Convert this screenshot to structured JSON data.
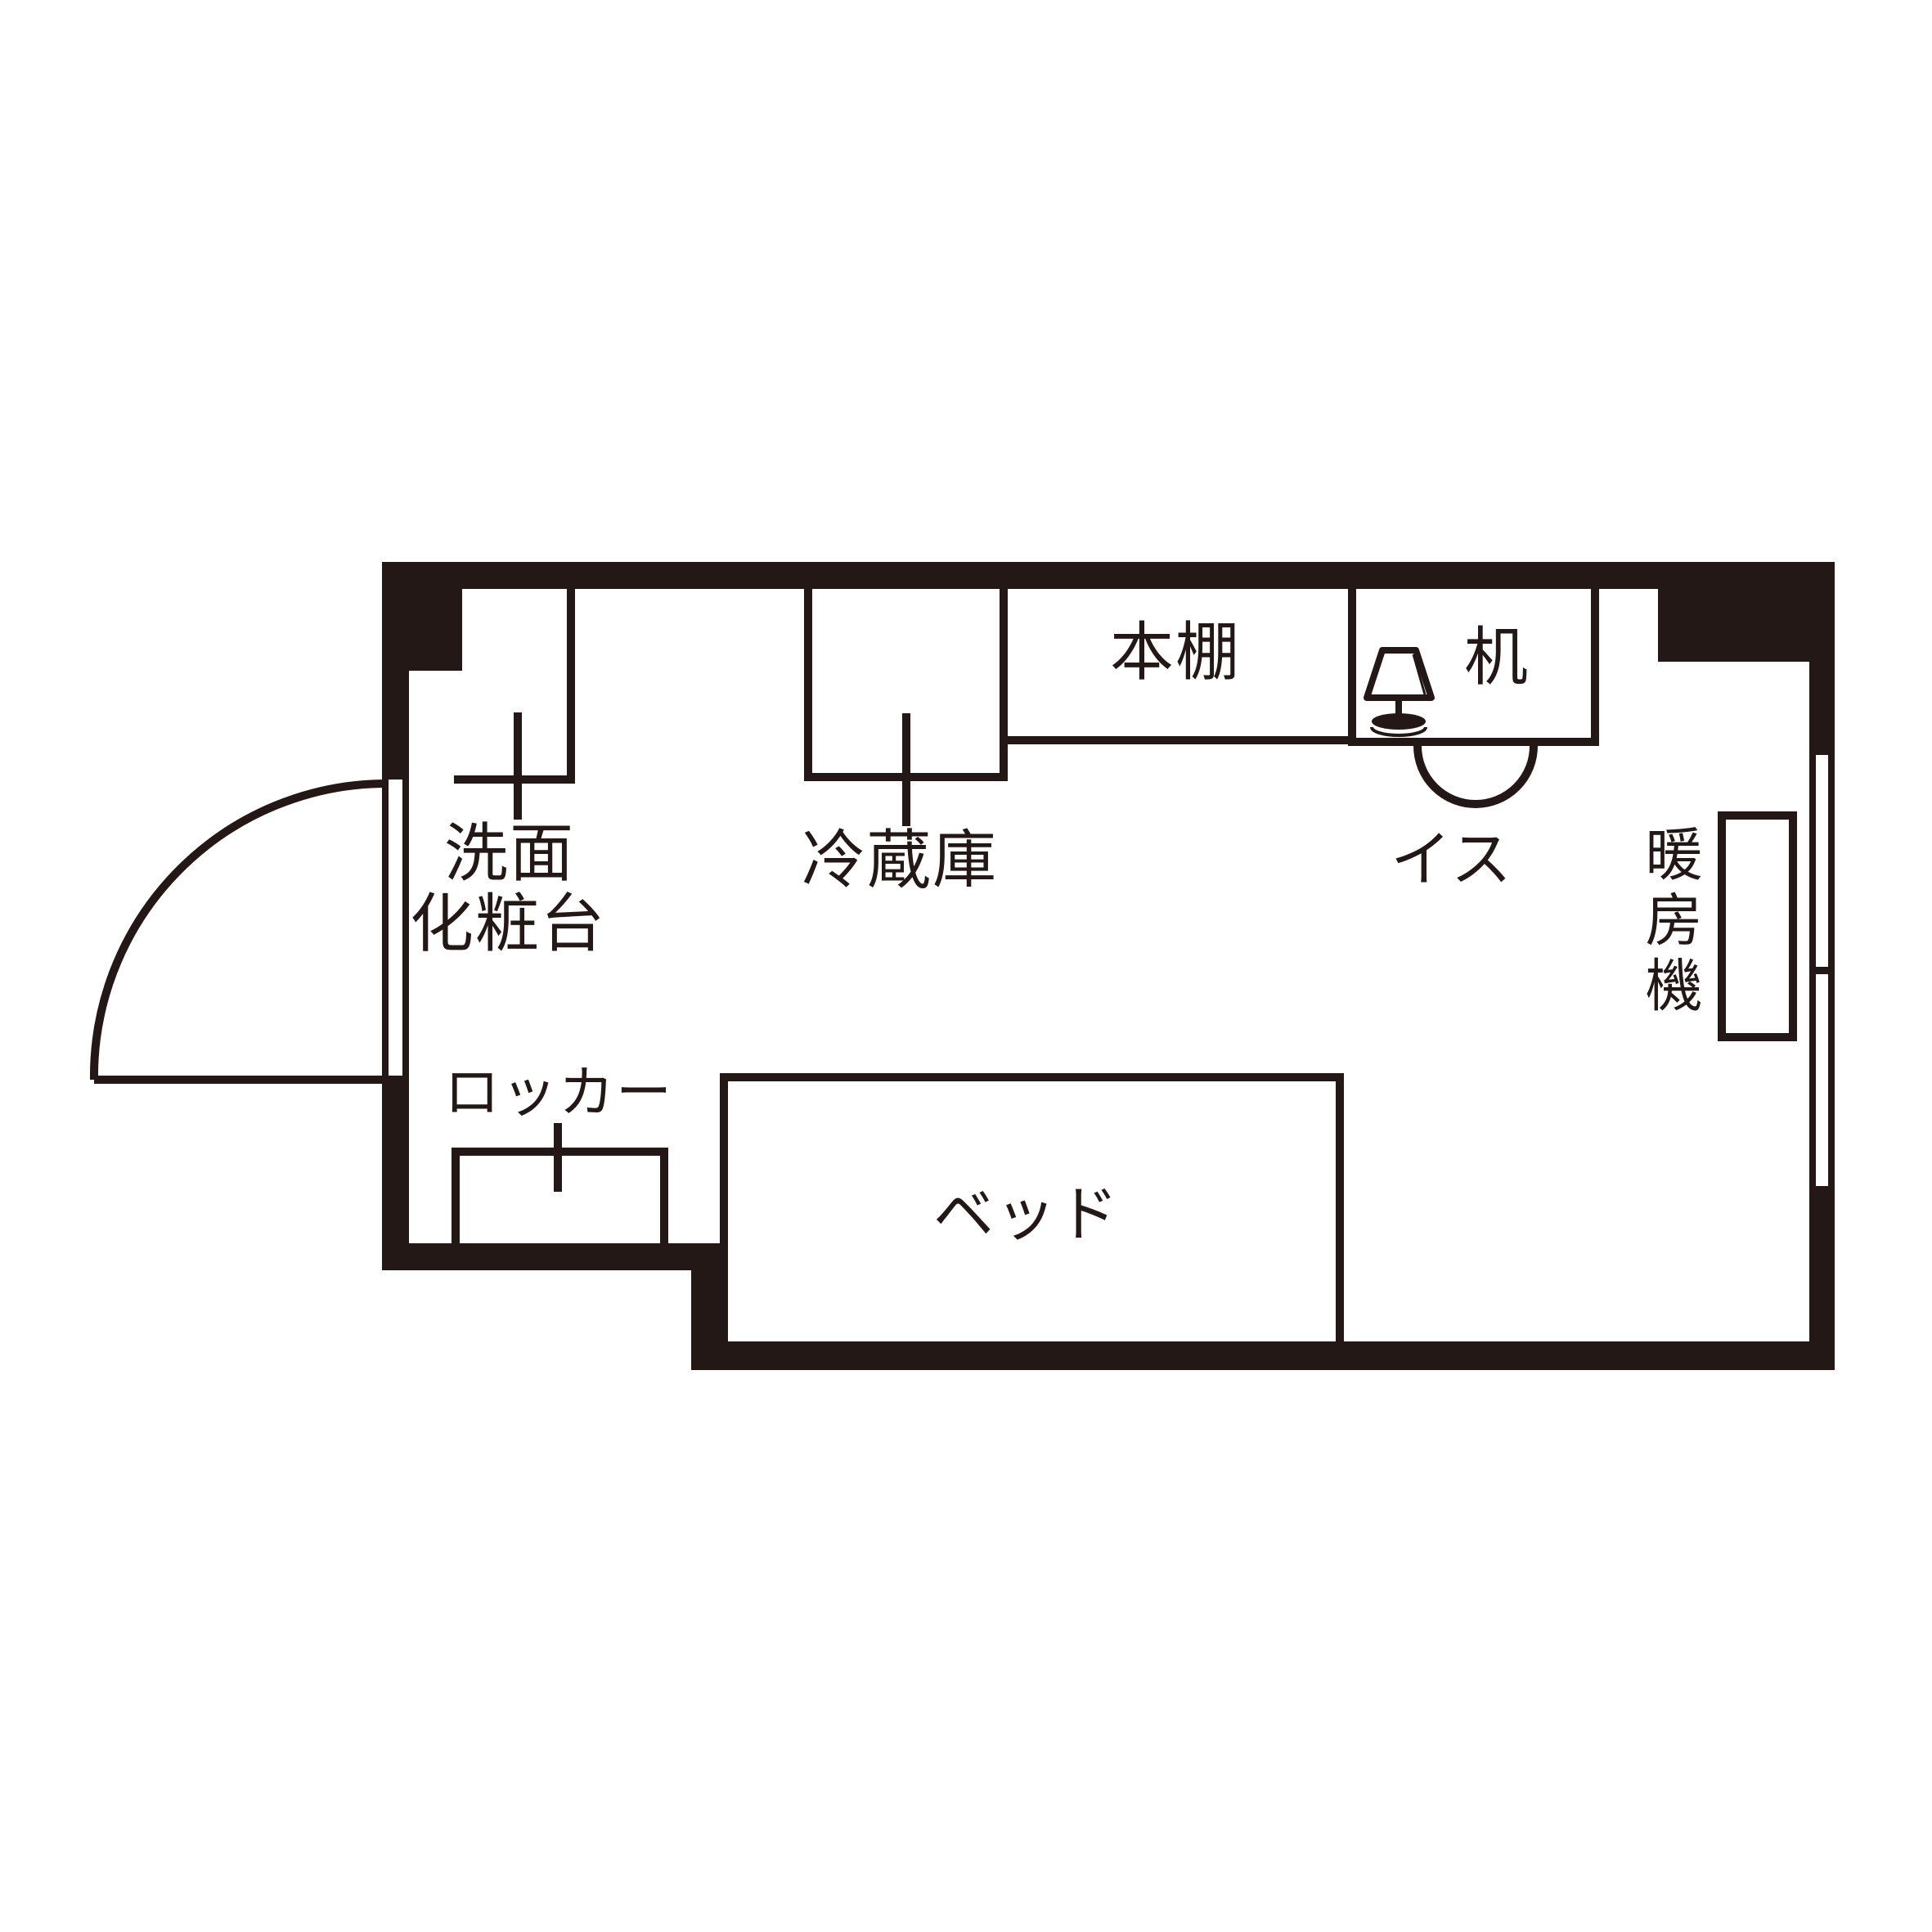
{
  "floorplan": {
    "type": "room-floorplan",
    "ink_color": "#231815",
    "background_color": "#ffffff",
    "labels": {
      "washbasin_line1": "洗面",
      "washbasin_line2": "化粧台",
      "refrigerator": "冷蔵庫",
      "bookshelf": "本棚",
      "desk": "机",
      "chair": "イス",
      "heater": "暖房機",
      "locker": "ロッカー",
      "bed": "ベッド"
    }
  }
}
